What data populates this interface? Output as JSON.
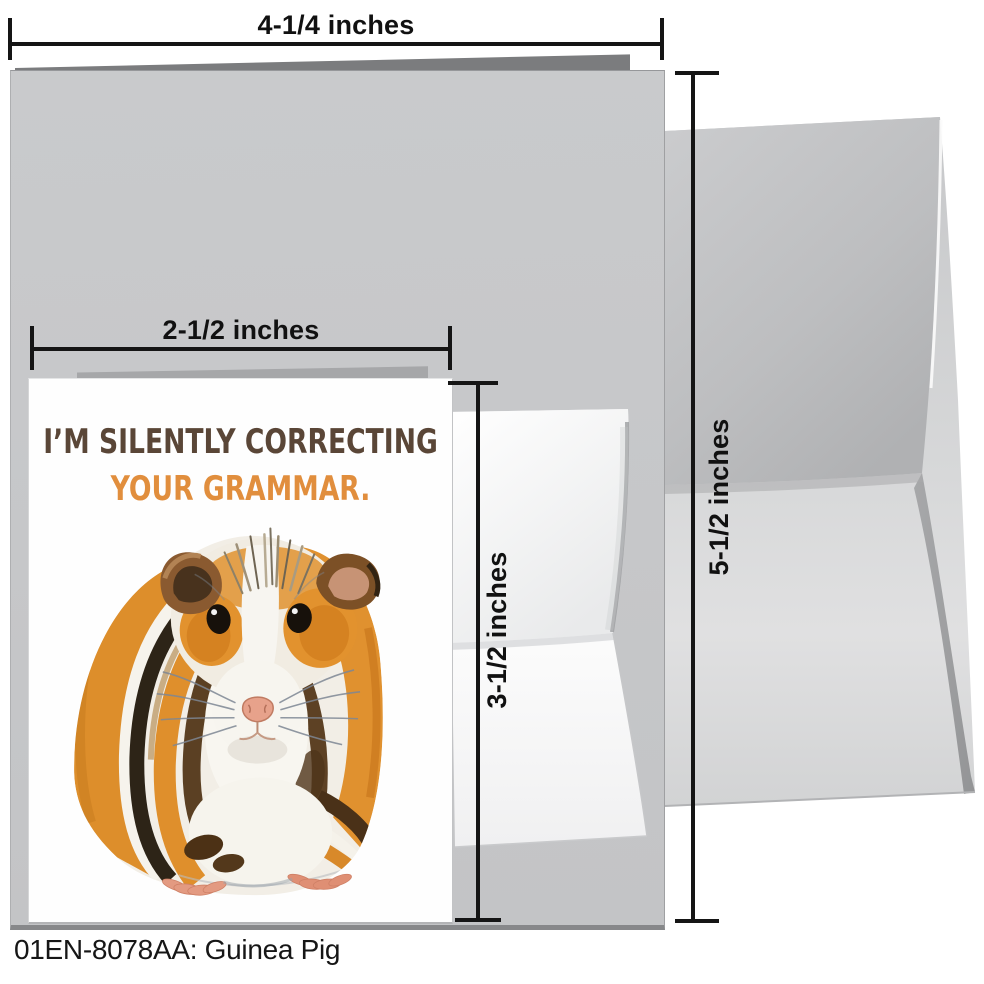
{
  "product": {
    "caption": "01EN-8078AA: Guinea Pig",
    "card_front": {
      "line1": "I’M SILENTLY CORRECTING",
      "line2": "YOUR GRAMMAR.",
      "line1_color": "#5a4637",
      "line2_color": "#e18e3d",
      "illustration": "guinea-pig-watercolor-painting"
    },
    "dimensions": {
      "open_card_width": "4-1/4 inches",
      "envelope_height": "5-1/2 inches",
      "front_width": "2-1/2 inches",
      "front_height": "3-1/2 inches"
    },
    "colors": {
      "card_inside_gray": "#c7c8ca",
      "card_fold_edge": "#7b7c7e",
      "large_envelope_gray": "#c9cacc",
      "small_envelope_white": "#f7f7f8",
      "dimension_line": "#151515",
      "pig_orange": "#e0912f",
      "pig_dark_brown": "#5b4023",
      "pig_black_stripe": "#2d2417",
      "pig_nose_pink": "#e7a28b"
    }
  }
}
